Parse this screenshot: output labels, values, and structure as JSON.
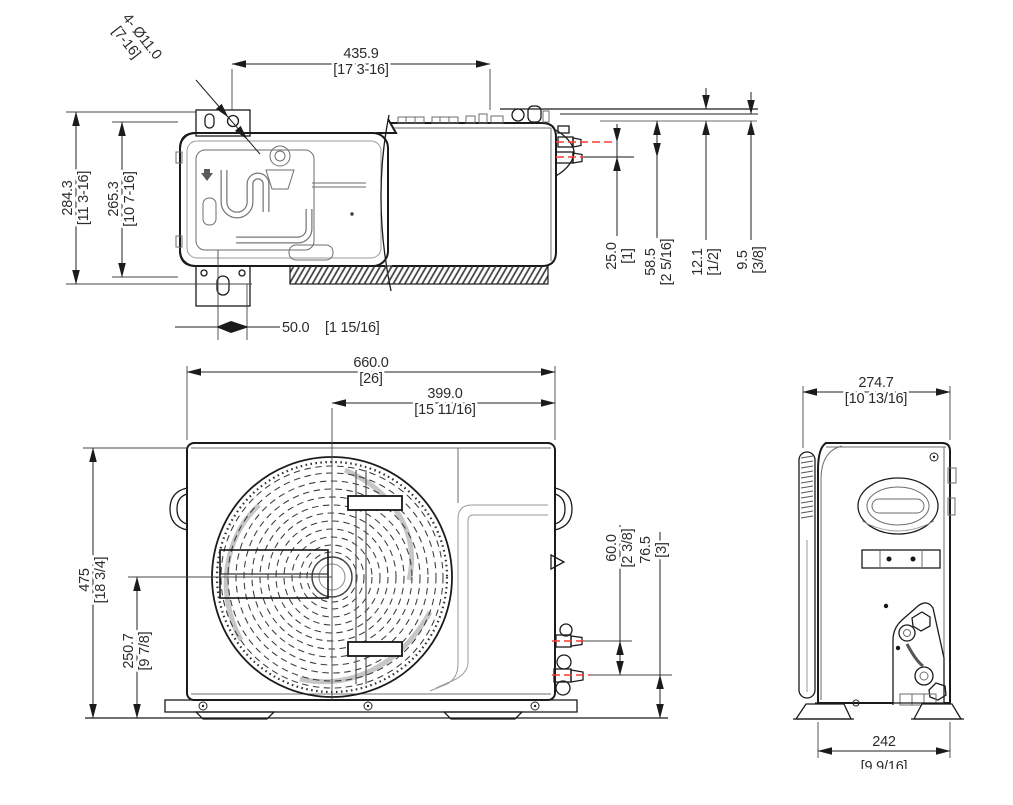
{
  "drawing": {
    "type": "dimensional-technical-drawing",
    "subject": "air-conditioner-outdoor-unit-three-views",
    "colors": {
      "line": "#1b1b1b",
      "centerline": "#ff3b30",
      "detail": "#6e6e6e"
    }
  },
  "dims": {
    "hole_qty": "4- Ø11.0",
    "hole_inch": "[7-16]",
    "top_width_mm": "435.9",
    "top_width_in": "[17 3-16]",
    "top_depth_mm": "284.3",
    "top_depth_in": "[11 3-16]",
    "top_depth_inner_mm": "265.3",
    "top_depth_inner_in": "[10 7-16]",
    "foot_offset_mm": "50.0",
    "foot_offset_in": "[1 15/16]",
    "valve_gap_mm": "25.0",
    "valve_gap_in": "[1]",
    "valve_offset_mm": "58.5",
    "valve_offset_in": "[2 5/16]",
    "gap_a_mm": "12.1",
    "gap_a_in": "[1/2]",
    "gap_b_mm": "9.5",
    "gap_b_in": "[3/8]",
    "front_width_mm": "660.0",
    "front_width_in": "[26]",
    "fan_offset_mm": "399.0",
    "fan_offset_in": "[15 11/16]",
    "front_height_mm": "475",
    "front_height_in": "[18 3/4]",
    "fan_height_mm": "250.7",
    "fan_height_in": "[9 7/8]",
    "front_valve_gap_mm": "60.0",
    "front_valve_gap_in": "[2 3/8]",
    "front_valve_h_mm": "76.5",
    "front_valve_h_in": "[3]",
    "side_depth_mm": "274.7",
    "side_depth_in": "[10 13/16]",
    "side_feet_mm": "242",
    "side_feet_in": "[9 9/16]"
  }
}
